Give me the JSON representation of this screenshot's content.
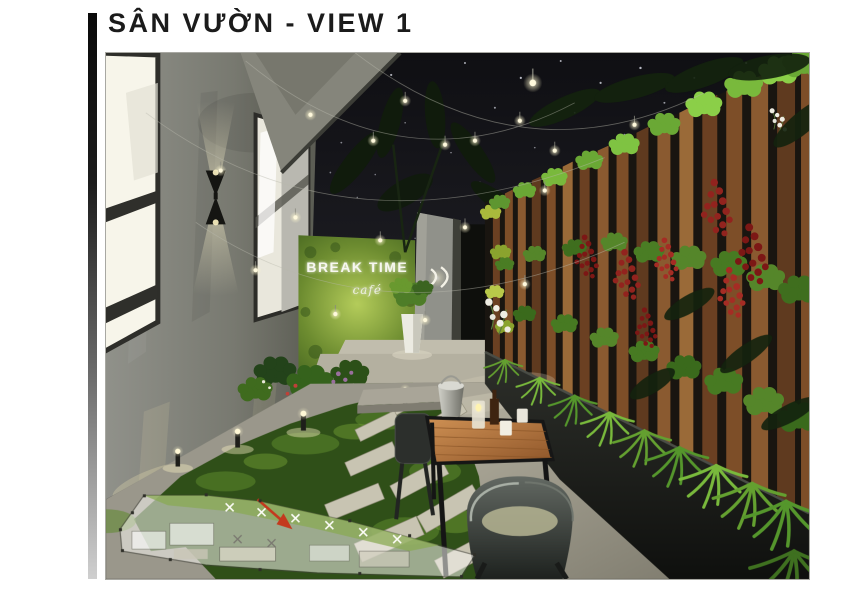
{
  "header": {
    "title": "SÂN VƯỜN - VIEW 1"
  },
  "scene": {
    "signage": {
      "brand": "BREAK TIME",
      "script": "café"
    },
    "colors": {
      "sky": "#121217",
      "left_wall": "#7f8077",
      "grass_sign_wall": "#7ca33d",
      "wood_slats": "#7a4a28",
      "foliage_green": "#4a8224",
      "foliage_red": "#8c1f1c",
      "ground": "#aaa79a",
      "table_wood": "#b5713a",
      "chair_metal": "#3a3e3b",
      "planter_box": "#212320",
      "plan_arrow": "#c4391d",
      "string_light": "#fff6d8",
      "accent_bar": "#0a0a0a"
    }
  }
}
